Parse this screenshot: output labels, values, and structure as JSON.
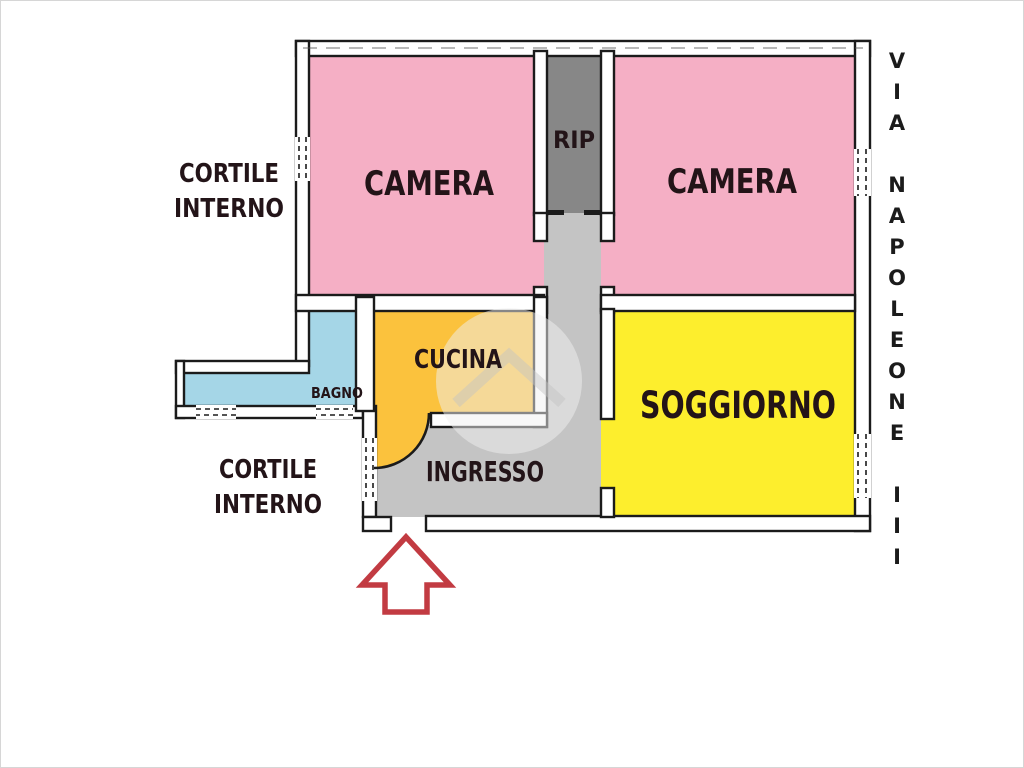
{
  "plan": {
    "rooms": {
      "camera_left": {
        "label": "CAMERA",
        "color": "#f5afc5"
      },
      "camera_right": {
        "label": "CAMERA",
        "color": "#f5afc5"
      },
      "rip": {
        "label": "RIP",
        "color": "#878787"
      },
      "bagno": {
        "label": "BAGNO",
        "color": "#a5d6e7"
      },
      "cucina": {
        "label": "CUCINA",
        "color": "#fbc23d"
      },
      "ingresso": {
        "label": "INGRESSO",
        "color": "#c4c4c4"
      },
      "soggiorno": {
        "label": "SOGGIORNO",
        "color": "#fdee2d"
      }
    },
    "outside": {
      "courtyard_top": {
        "line1": "CORTILE",
        "line2": "INTERNO"
      },
      "courtyard_bottom": {
        "line1": "CORTILE",
        "line2": "INTERNO"
      },
      "street": "VIA NAPOLEONE III"
    },
    "entrance_arrow": {
      "direction": "up",
      "color": "#c23b42"
    },
    "colors": {
      "wall": "#1b1b1b",
      "label_text": "#231418",
      "watermark": "#d8d8d8"
    }
  }
}
